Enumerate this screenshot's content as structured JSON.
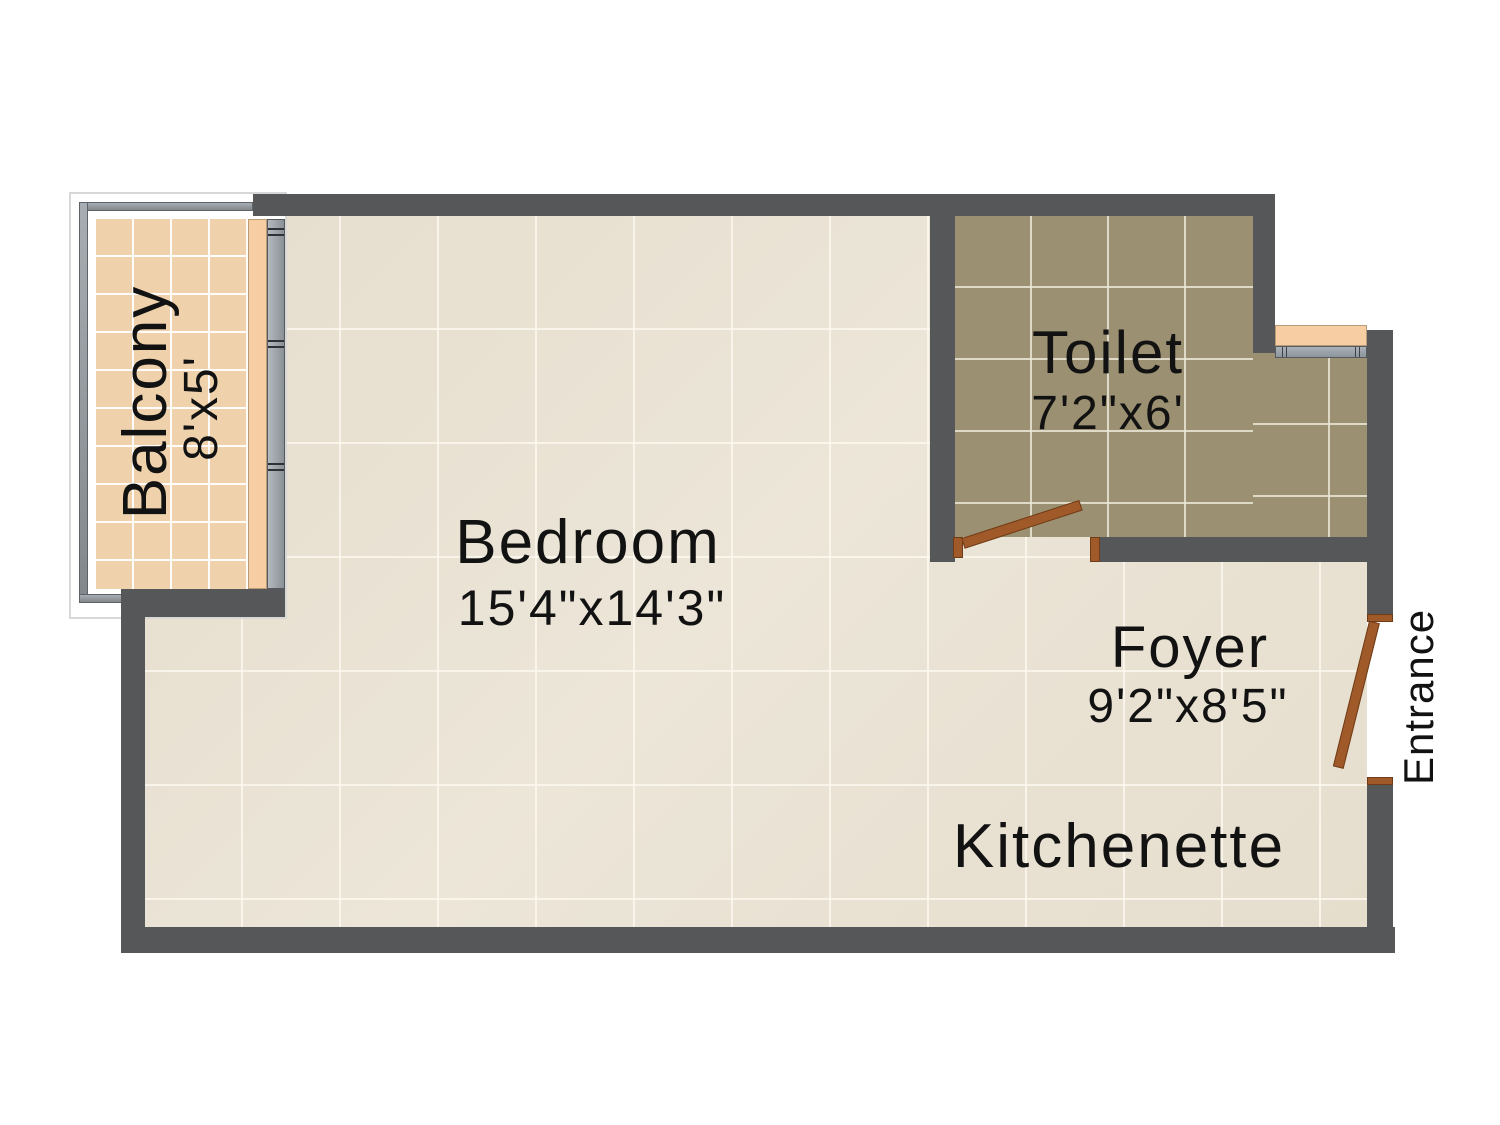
{
  "plan": {
    "rooms": [
      {
        "name": "Balcony",
        "dims": "8'x5'"
      },
      {
        "name": "Bedroom",
        "dims": "15'4\"x14'3\""
      },
      {
        "name": "Toilet",
        "dims": "7'2\"x6'"
      },
      {
        "name": "Foyer",
        "dims": "9'2\"x8'5\""
      },
      {
        "name": "Kitchenette",
        "dims": ""
      }
    ],
    "entrance_label": "Entrance",
    "colors": {
      "wall": "#565759",
      "floor_tile": "#e9e2d3",
      "toilet_tile": "#9b9071",
      "balcony_tile": "#efd2ab",
      "sill_peach": "#f7cda3",
      "window_gray": "#9aa2aa",
      "door_brown": "#a05a2a",
      "railing_gray": "#979da2"
    }
  }
}
